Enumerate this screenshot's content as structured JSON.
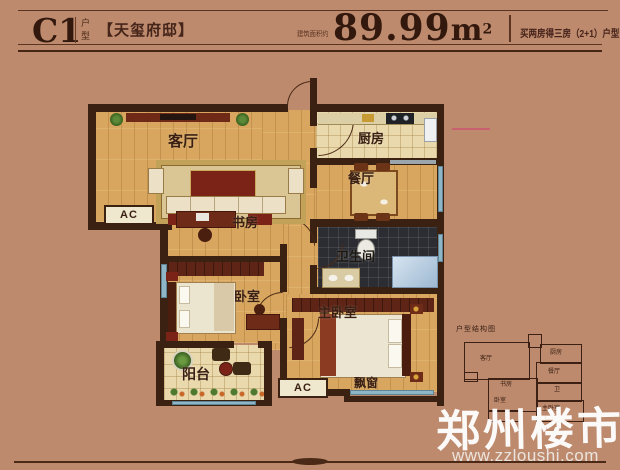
{
  "header": {
    "code": "C1",
    "code_side_top": "户",
    "code_side_bottom": "型",
    "project_name": "【天玺府邸】",
    "area_prefix": "建筑面积约",
    "area_value": "89.99",
    "area_unit": "m",
    "area_sup": "2",
    "promo": "买两房得三房（2+1）户型"
  },
  "plan": {
    "rooms": {
      "living": "客厅",
      "kitchen": "厨房",
      "dining": "餐厅",
      "study": "书房",
      "bathroom": "卫生间",
      "bedroom": "卧室",
      "master": "主卧室",
      "balcony": "阳台",
      "bay_window": "飘窗"
    },
    "ac_label": "AC"
  },
  "mini_map": {
    "title": "户型结构图",
    "labels": {
      "living": "客厅",
      "kitchen": "厨房",
      "dining": "餐厅",
      "study": "书房",
      "bedroom": "卧室",
      "bath": "卫",
      "master": "主卧室"
    }
  },
  "watermark": {
    "brand": "郑州楼市",
    "url": "www.zzloushi.com"
  },
  "colors": {
    "background": "#bd8a6d",
    "wall": "#3a2112",
    "wood_floor": "#d8a65e",
    "tile_light": "#ead9ac",
    "tile_dark": "#2b2d33",
    "window_blue": "#8fb6c6",
    "accent_red_line": "#cc5570",
    "header_text": "#3b2013",
    "watermark_white": "#ffffff"
  }
}
